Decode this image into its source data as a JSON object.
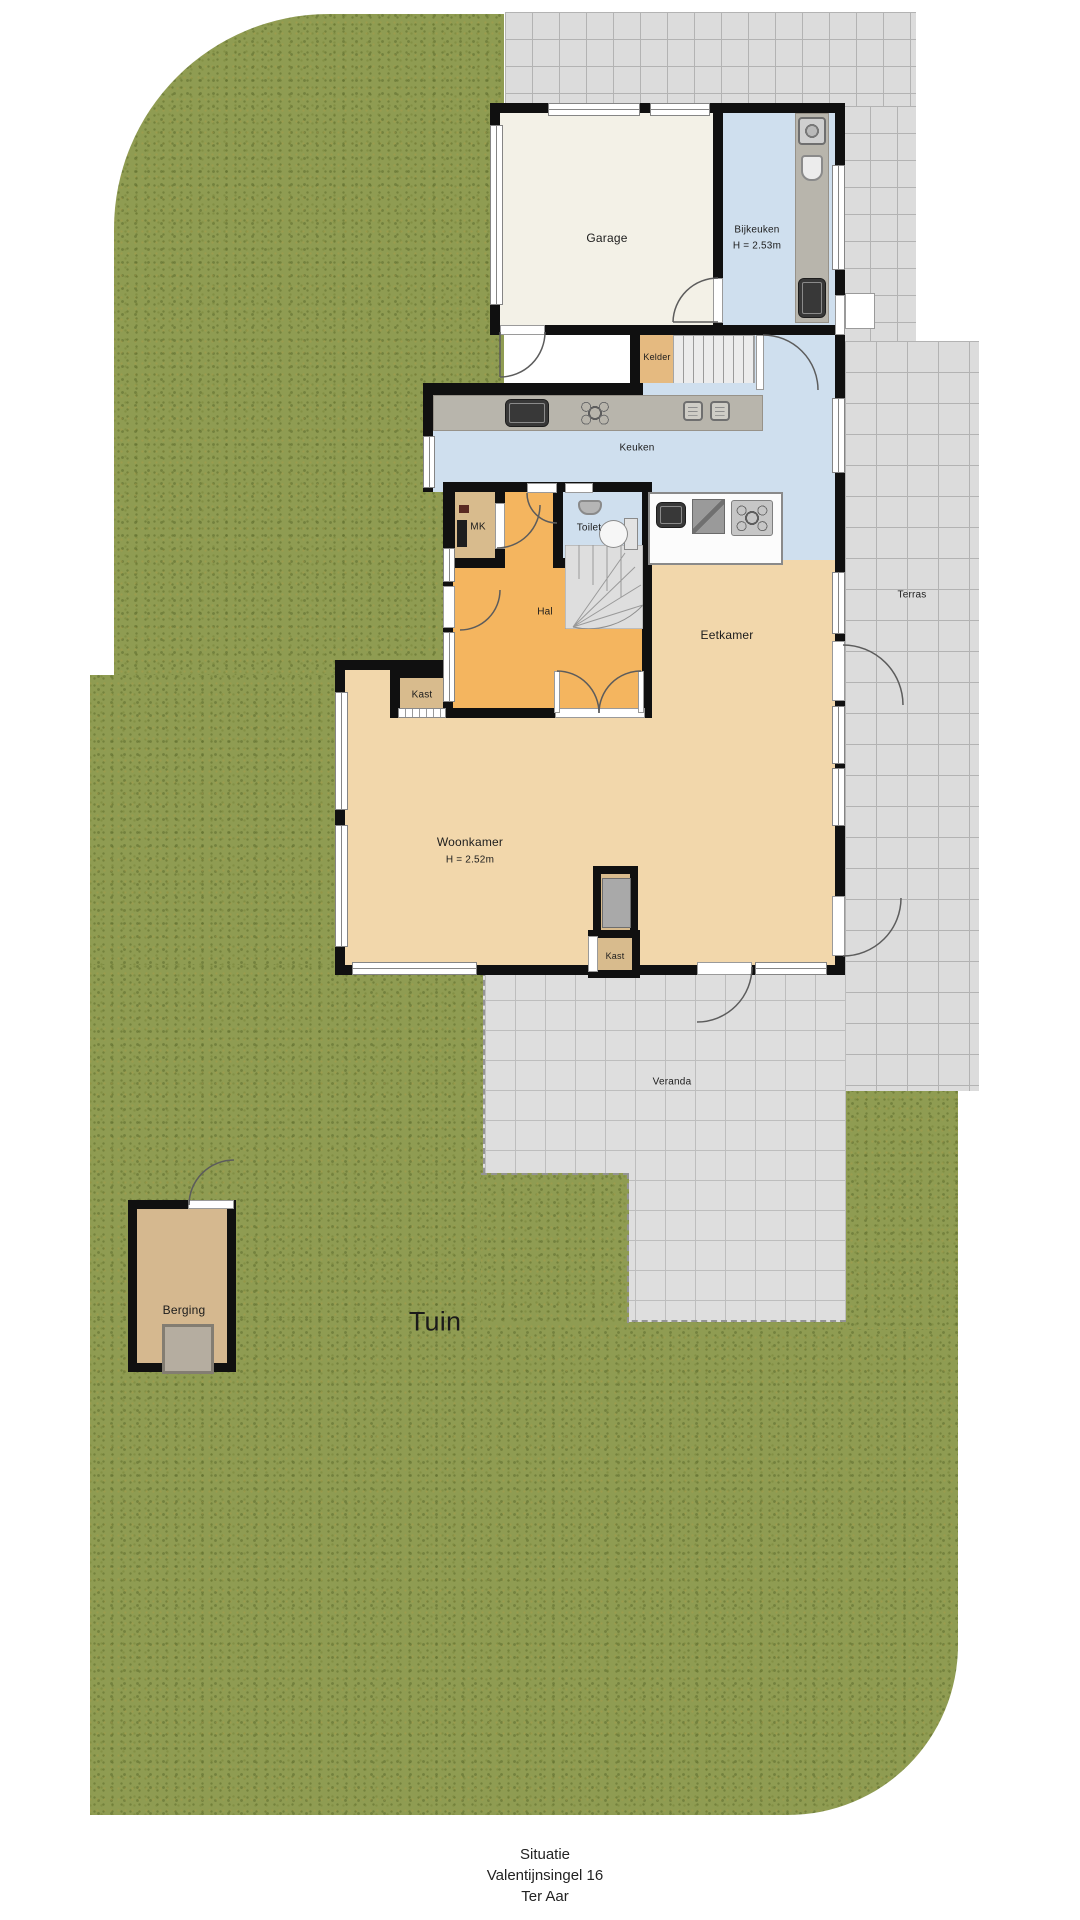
{
  "plan": {
    "rooms": {
      "garage": "Garage",
      "bijkeuken": "Bijkeuken",
      "bijkeuken_height": "H = 2.53m",
      "kelder": "Kelder",
      "keuken": "Keuken",
      "mk": "MK",
      "toilet": "Toilet",
      "hal": "Hal",
      "eetkamer": "Eetkamer",
      "kast_top": "Kast",
      "woonkamer": "Woonkamer",
      "woonkamer_height": "H = 2.52m",
      "kast_bottom": "Kast",
      "terras": "Terras",
      "veranda": "Veranda",
      "berging": "Berging",
      "tuin": "Tuin"
    },
    "caption": {
      "line1": "Situatie",
      "line2": "Valentijnsingel 16",
      "line3": "Ter Aar"
    },
    "colors": {
      "grass": "#8f9c52",
      "tile": "#dcdcdc",
      "wall": "#101010",
      "living": "#f2d7ab",
      "hal": "#f4b55f",
      "kitchen": "#cfdfee",
      "garage": "#f3f1e7",
      "closet": "#d8bb8d",
      "kelder": "#e5ba80",
      "counter": "#b8b5ac"
    }
  }
}
